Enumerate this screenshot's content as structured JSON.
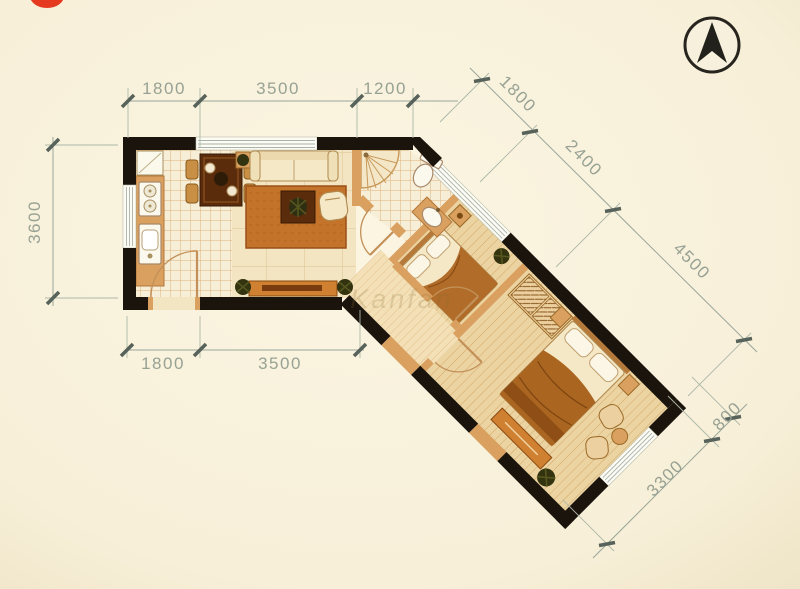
{
  "page": {
    "type": "apartment-floor-plan"
  },
  "logo": {
    "color": "#e63a20"
  },
  "compass": {
    "icon": "north-arrow-icon"
  },
  "watermark": {
    "text": "Kanfan"
  },
  "dimensions": {
    "top": {
      "segments": [
        "1800",
        "3500",
        "1200"
      ]
    },
    "left": {
      "segments": [
        "3600"
      ]
    },
    "bottom": {
      "segments": [
        "1800",
        "3500"
      ]
    },
    "upper_diagonal": {
      "segments": [
        "1800",
        "2400",
        "4500"
      ]
    },
    "lower_diagonal": {
      "segments": [
        "800",
        "3300"
      ]
    }
  },
  "colors": {
    "paper": "#f8f1dc",
    "wall": "#1b140d",
    "partition_wall": "#d9a05f",
    "dimension_text": "#98a294",
    "wood_floor": "#ecd4a2",
    "tile_floor": "#f7eed8",
    "rug": "#c4742a",
    "accent_orange": "#cf8030",
    "logo_red": "#e63a20"
  }
}
